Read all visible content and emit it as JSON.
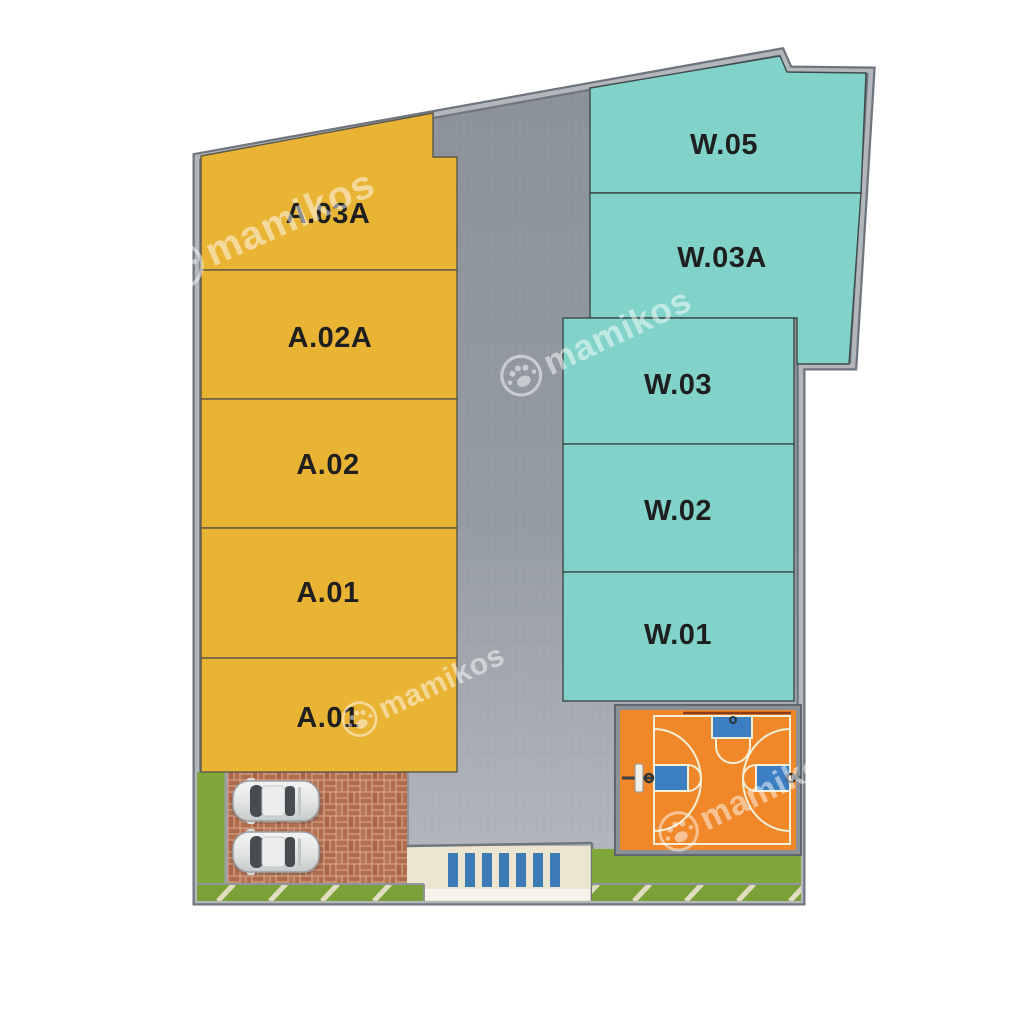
{
  "site_plan": {
    "watermark_text": "mamikos",
    "unit_blocks": [
      {
        "label": "A.03A",
        "wing": "A",
        "color": "#e9b434"
      },
      {
        "label": "A.02A",
        "wing": "A",
        "color": "#e9b434"
      },
      {
        "label": "A.02",
        "wing": "A",
        "color": "#e9b434"
      },
      {
        "label": "A.01",
        "wing": "A",
        "color": "#e9b434"
      },
      {
        "label": "A.01",
        "wing": "A",
        "color": "#e9b434"
      },
      {
        "label": "W.05",
        "wing": "W",
        "color": "#81d3ca"
      },
      {
        "label": "W.03A",
        "wing": "W",
        "color": "#81d3ca"
      },
      {
        "label": "W.03",
        "wing": "W",
        "color": "#81d3ca"
      },
      {
        "label": "W.02",
        "wing": "W",
        "color": "#81d3ca"
      },
      {
        "label": "W.01",
        "wing": "W",
        "color": "#81d3ca"
      }
    ],
    "colors": {
      "road": "#939aa3",
      "boundary_wall_light": "#b3b7bc",
      "boundary_wall_dark": "#6f757d",
      "court_surface": "#f08728",
      "court_key_blue": "#3b7ec2",
      "court_line_cream": "#f6efd8",
      "grass": "#81a63a",
      "sidewalk_cream": "#ece6d1",
      "crosswalk_blue": "#3d7ab8",
      "brick_paving": "#b26d4f",
      "label_text": "#1f1f1f"
    }
  }
}
